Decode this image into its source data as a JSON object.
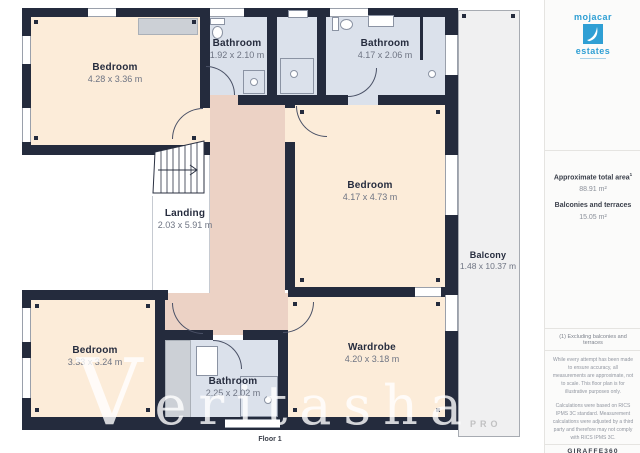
{
  "plan": {
    "floor_label": "Floor 1",
    "rooms": [
      {
        "id": "bedroom-top-left",
        "name": "Bedroom",
        "dims": "4.28 x 3.36 m"
      },
      {
        "id": "bathroom-top-center",
        "name": "Bathroom",
        "dims": "1.92 x 2.10 m"
      },
      {
        "id": "bathroom-top-right",
        "name": "Bathroom",
        "dims": "4.17 x 2.06 m"
      },
      {
        "id": "bedroom-mid-right",
        "name": "Bedroom",
        "dims": "4.17 x 4.73 m"
      },
      {
        "id": "landing",
        "name": "Landing",
        "dims": "2.03 x 5.91 m"
      },
      {
        "id": "bedroom-bottom-left",
        "name": "Bedroom",
        "dims": "3.33 x 3.24 m"
      },
      {
        "id": "bathroom-bottom",
        "name": "Bathroom",
        "dims": "2.25 x 2.02 m"
      },
      {
        "id": "wardrobe",
        "name": "Wardrobe",
        "dims": "4.20 x 3.18 m"
      },
      {
        "id": "balcony",
        "name": "Balcony",
        "dims": "1.48 x 10.37 m"
      }
    ]
  },
  "watermark": {
    "main": "Veritasha",
    "sub": "PRO"
  },
  "sidebar": {
    "logo": {
      "top": "mojacar",
      "bottom": "estates"
    },
    "area": {
      "title": "Approximate total area",
      "sup": "1",
      "total": "88.91 m²",
      "bal_label": "Balconies and terraces",
      "bal_value": "15.05 m²"
    },
    "footnote": "(1) Excluding balconies and terraces",
    "disclaimer1": "While every attempt has been made to ensure accuracy, all measurements are approximate, not to scale. This floor plan is for illustrative purposes only.",
    "disclaimer2": "Calculations were based on RICS IPMS 3C standard. Measurement calculations were adjusted by a third party and therefore may not comply with RICS IPMS 3C.",
    "brand": "GIRAFFE360"
  },
  "colors": {
    "wall": "#242b3d",
    "bedroom_fill": "#fcecd9",
    "hall_fill": "#ecd2c5",
    "bathroom_fill": "#dbe1eb",
    "balcony_fill": "#f0f0f1",
    "brand_blue": "#2f9fd4"
  }
}
